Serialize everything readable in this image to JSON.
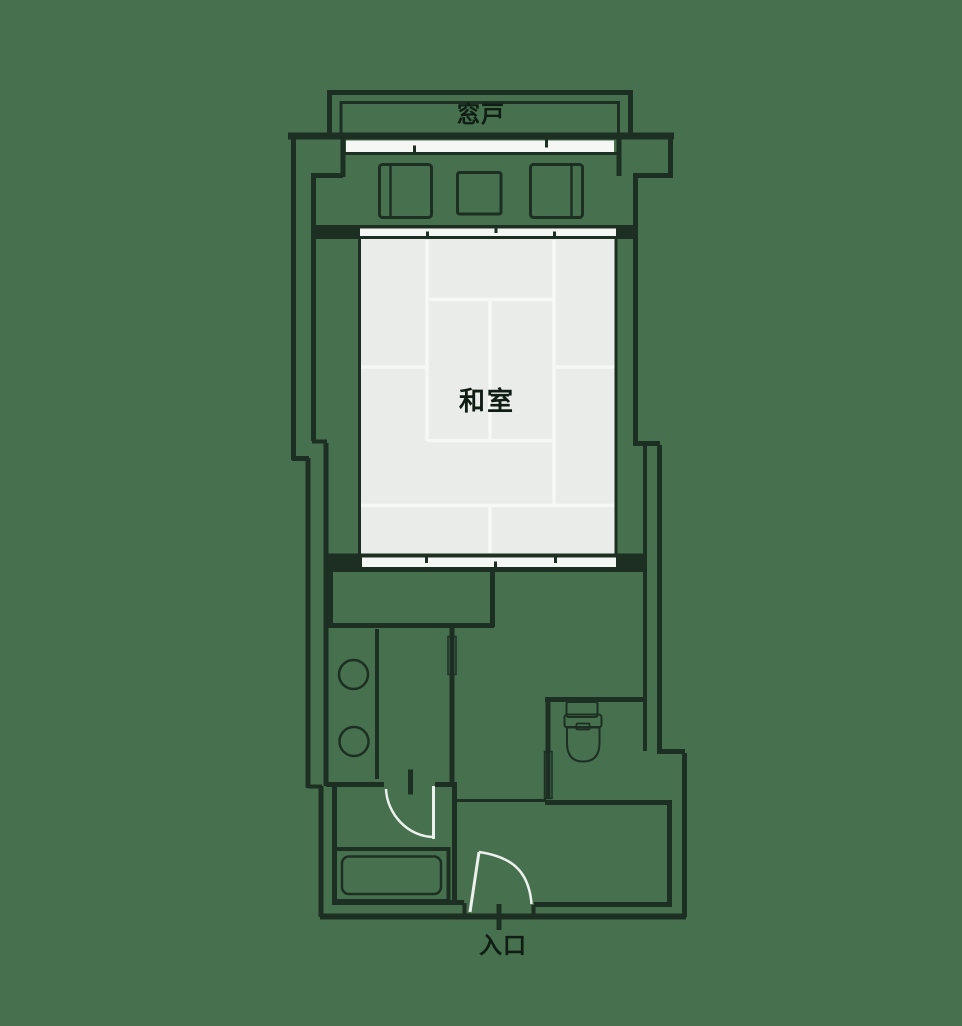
{
  "diagram": {
    "type": "floor-plan",
    "labels": {
      "window_door": "窓戸",
      "tatami_room": "和室",
      "entrance": "入口"
    },
    "features": {
      "window_bay": "window-band-with-3-panels",
      "closet_squares_count": 3,
      "sliding_door_panels_top": 4,
      "sliding_door_panels_bottom": 4,
      "wash_basins_count": 2,
      "fixtures": [
        "toilet",
        "bathtub",
        "wash-basins",
        "entrance-swing-door",
        "bathroom-swing-door",
        "toilet-sliding-door",
        "corridor-sliding-door"
      ]
    },
    "colors": {
      "background": "#47704e",
      "wall": "#1d2f23",
      "tatami_fill": "#e9ece9",
      "mat_line": "#f6f8f6",
      "panel_white": "#f5f7f5",
      "square_fill": "#eef1ee",
      "fixture_fill": "#f7f9f7",
      "door_white": "#edf1ed",
      "text": "#101d14"
    }
  }
}
